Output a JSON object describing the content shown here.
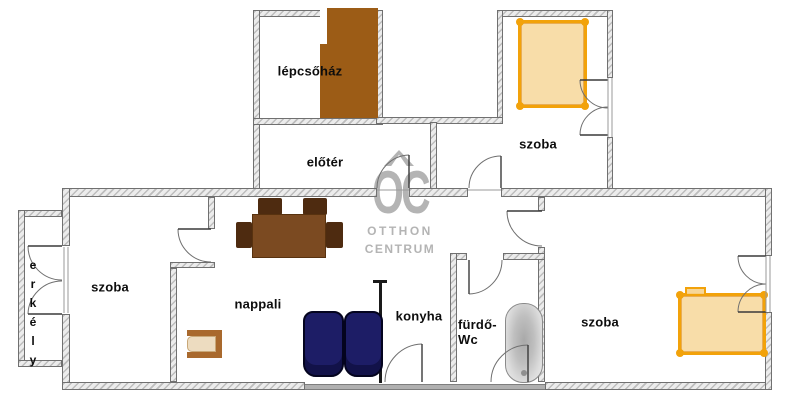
{
  "plan": {
    "title": "apartment floor plan",
    "rooms": {
      "lepcsohaz": "lépcsőház",
      "eloter": "előtér",
      "szoba_top": "szoba",
      "szoba_left": "szoba",
      "nappali": "nappali",
      "konyha": "konyha",
      "furdo_line1": "fürdő-",
      "furdo_line2": "Wc",
      "szoba_right": "szoba",
      "erkely": "erkély"
    },
    "watermark": {
      "logo": "OC",
      "line1": "OTTHON",
      "line2": "CENTRUM"
    },
    "colors": {
      "accent_orange": "#f2a20a",
      "bed_fill": "#f6d28c",
      "stairs_brown": "#9c5c16",
      "table_brown": "#7b4a21",
      "chair_brown": "#4e2b10",
      "couch_navy": "#1d1d66",
      "armchair_frame": "#a9692d",
      "armchair_cushion": "#eddcc0",
      "wall_gray": "#ececec",
      "watermark_gray": "#b4b4b4"
    }
  }
}
